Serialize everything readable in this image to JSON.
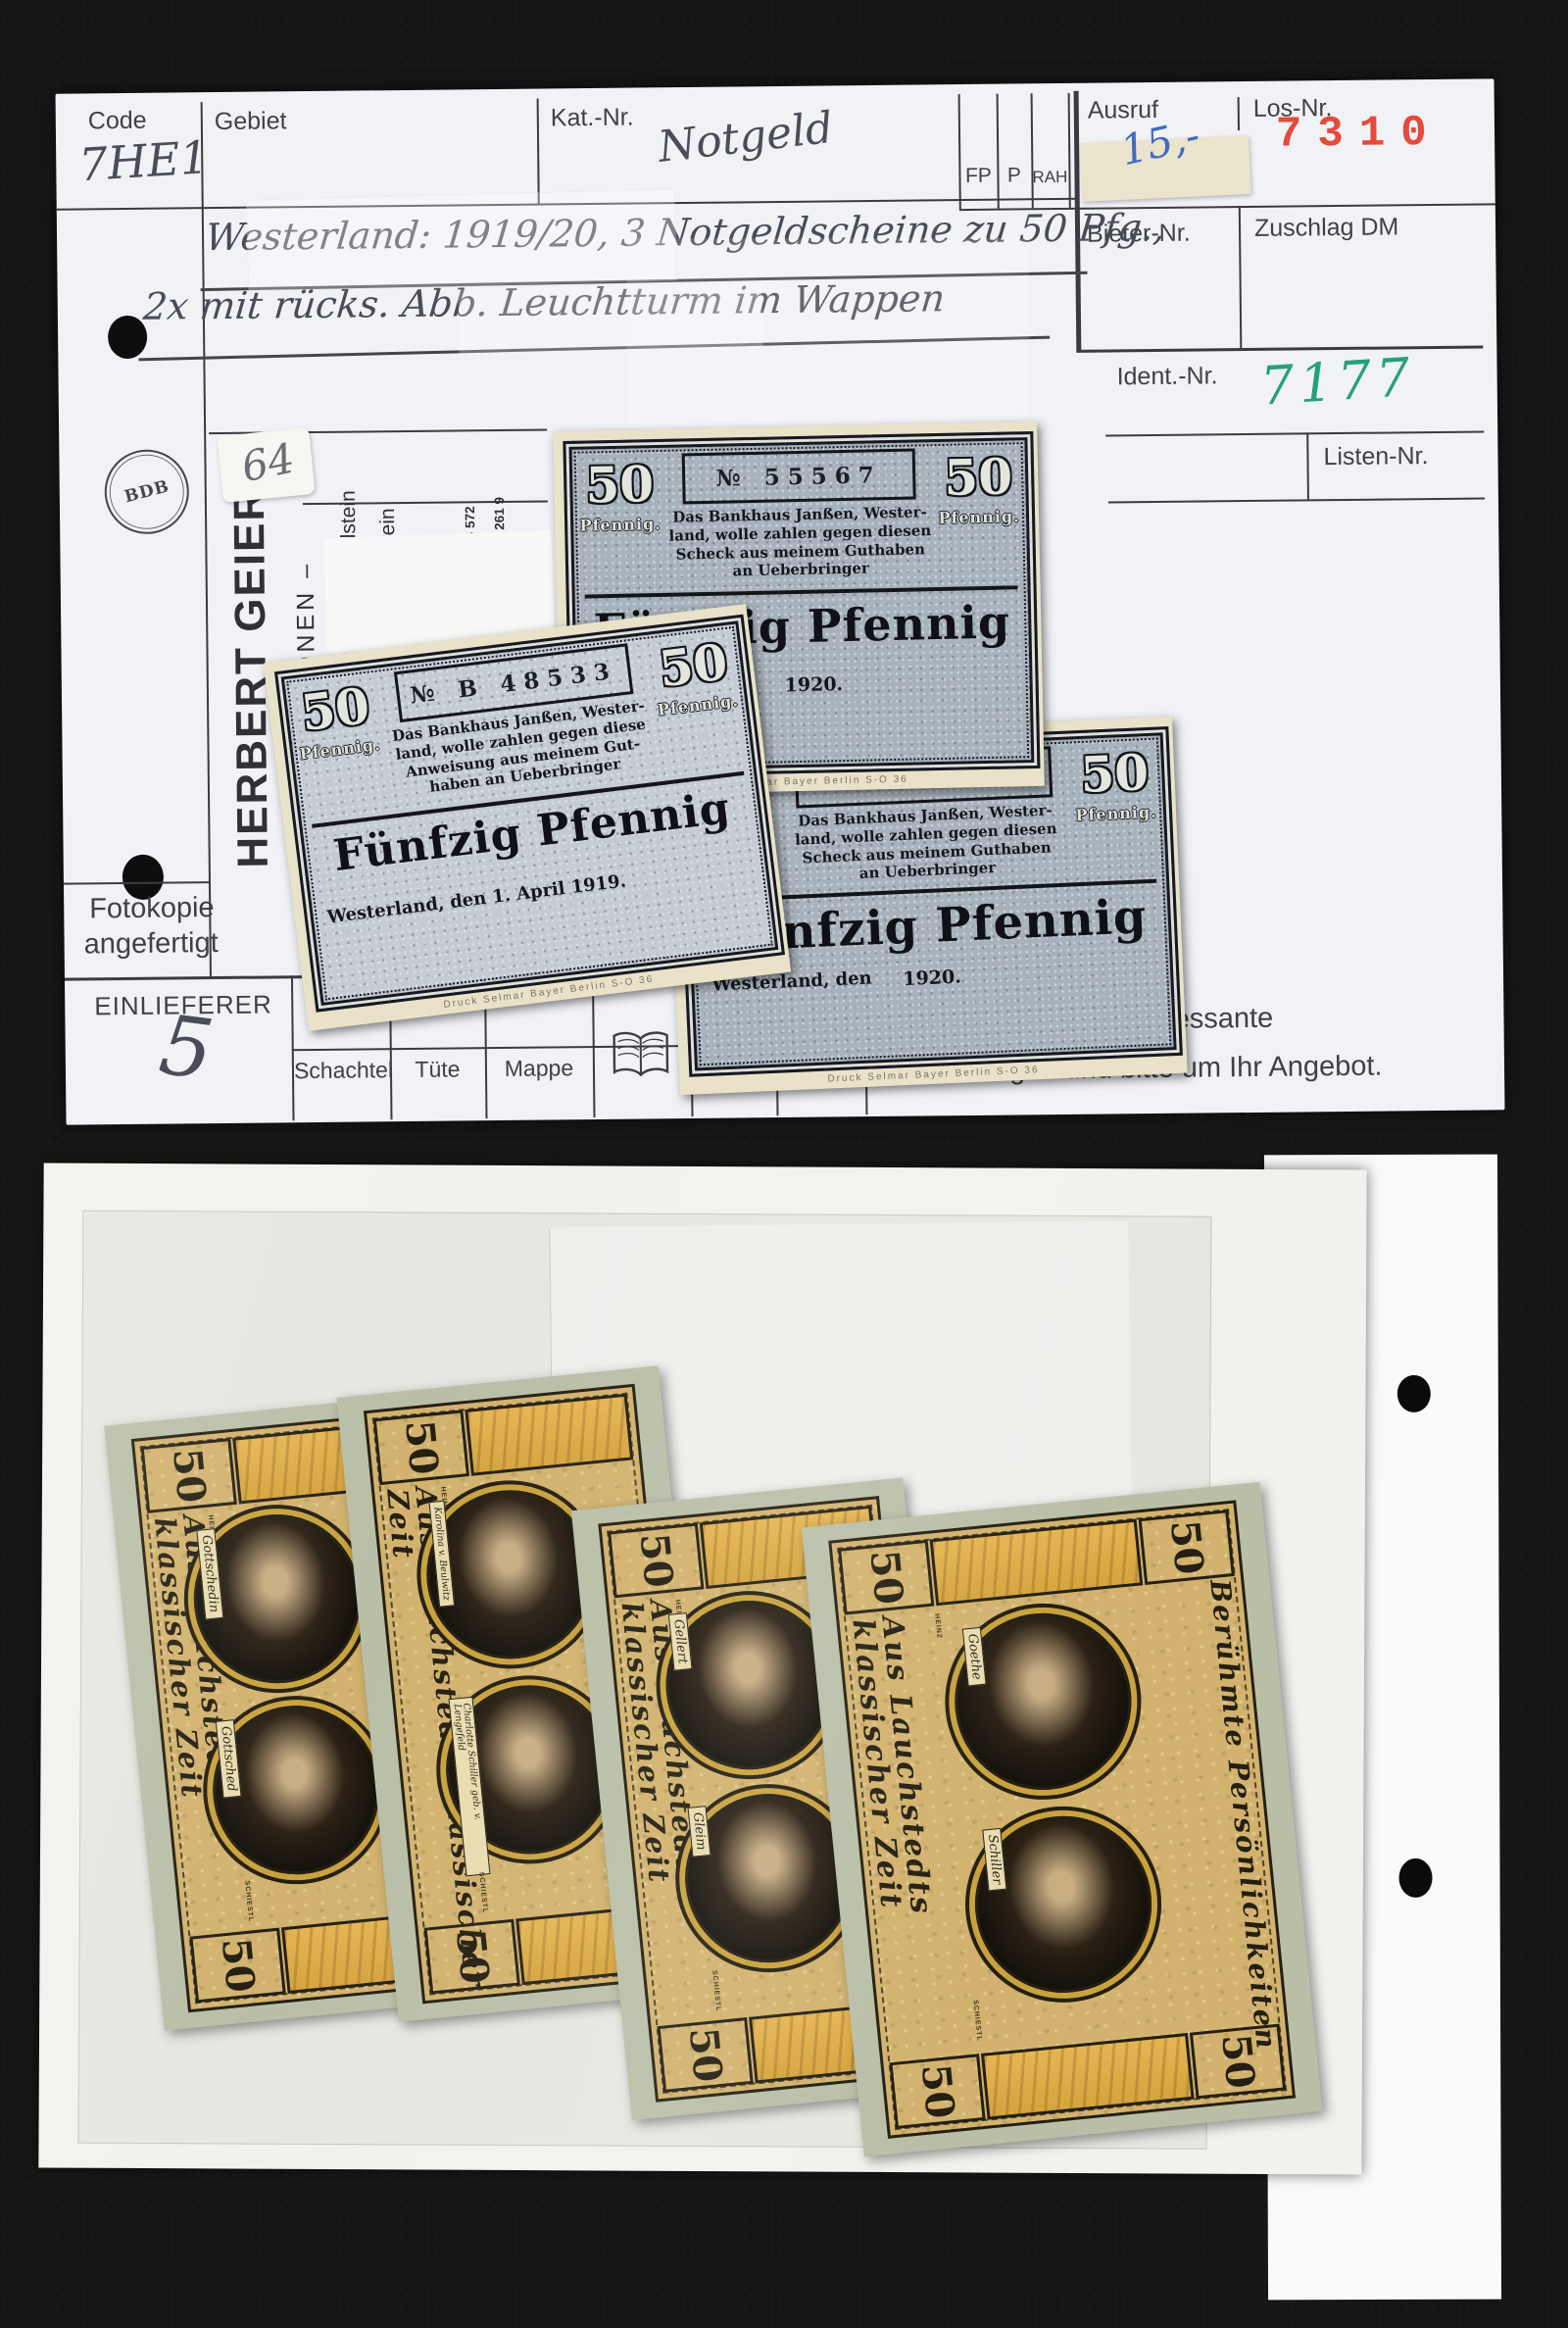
{
  "card": {
    "header": {
      "code_label": "Code",
      "code_value": "7HE1",
      "gebiet_label": "Gebiet",
      "kat_label": "Kat.-Nr.",
      "kat_value": "Notgeld",
      "fp_label": "FP",
      "p_label": "P",
      "rah_label": "RAH.",
      "ausruf_label": "Ausruf",
      "ausruf_value": "15,-",
      "los_label": "Los-Nr.",
      "los_value": "7310"
    },
    "right_fields": {
      "bieter_label": "Bieter-Nr.",
      "zuschlag_label": "Zuschlag DM",
      "ident_label": "Ident.-Nr.",
      "ident_value": "7177",
      "listen_label": "Listen-Nr."
    },
    "description": {
      "line1": "Westerland: 1919/20, 3 Notgeldscheine zu 50 Pfg.,",
      "line2": "2x mit rücks. Abb. Leuchtturm im Wappen"
    },
    "sticker_64": "64",
    "sidebar": {
      "logo_text": "BDB",
      "name": "HERBERT GEIER",
      "subtitle": "– AUKTIONEN –",
      "address1": "Alberadastraße 13 · D-96231 Staffelstein",
      "address2": "Postfach 1308 · D-96227 Staffelstein",
      "phone": "Telefon 09573/1870",
      "bank1": "Postgiroamt München, BLZ 700 100 80, Konto 286 572",
      "bank2": "Kreissparkasse Lichtenfels, BLZ 770 518 60, Konto 261 9"
    },
    "fotokopie_line1": "Fotokopie",
    "fotokopie_line2": "angefertigt",
    "einlieferer_label": "EINLIEFERER",
    "einlieferer_value": "5",
    "bins": [
      "Schachtel",
      "Tüte",
      "Mappe",
      "Album",
      "Karton"
    ],
    "notice_line1": "sgefallene und interessante",
    "notice_line2": "Einlieferungen und bitte um Ihr Angebot."
  },
  "blue_notes": {
    "denomination": "50",
    "denomination_unit": "Pfennig.",
    "main_text": "Fünfzig Pfennig",
    "printer": "Druck Selmar Bayer Berlin S-O 36",
    "note_a": {
      "serial": "№ 55567",
      "body1": "Das Bankhaus Janßen, Wester-",
      "body2": "land, wolle zahlen gegen diesen",
      "body3": "Scheck aus meinem Guthaben",
      "body4": "an Ueberbringer",
      "date": "1920."
    },
    "note_b": {
      "serial": "№ B 48533",
      "body1": "Das Bankhaus Janßen, Wester-",
      "body2": "land, wolle zahlen gegen diese",
      "body3": "Anweisung aus meinem Gut-",
      "body4": "haben an Ueberbringer",
      "date": "Westerland, den 1. April 1919."
    },
    "note_c": {
      "serial": "№ 55566",
      "body1": "Das Bankhaus Janßen, Wester-",
      "body2": "land, wolle zahlen gegen diesen",
      "body3": "Scheck aus meinem Guthaben",
      "body4": "an Ueberbringer",
      "date_left": "Westerland, den",
      "date_right": "1920."
    }
  },
  "photo_notes": {
    "denomination": "50",
    "series_title": "Aus Lauchstedts klassischer Zeit",
    "series_title_right": "Berühmte Persönlichkeiten",
    "artist1": "HEINZ",
    "artist2": "SCHIESTL",
    "notes": [
      {
        "portrait_top": "Gottschedin",
        "portrait_bottom": "Gottsched"
      },
      {
        "portrait_top": "Karolina v. Beulwitz",
        "portrait_bottom": "Charlotte Schiller geb. v. Lengefeld"
      },
      {
        "portrait_top": "Gellert",
        "portrait_bottom": "Gleim"
      },
      {
        "portrait_top": "Goethe",
        "portrait_bottom": "Schiller"
      }
    ]
  }
}
